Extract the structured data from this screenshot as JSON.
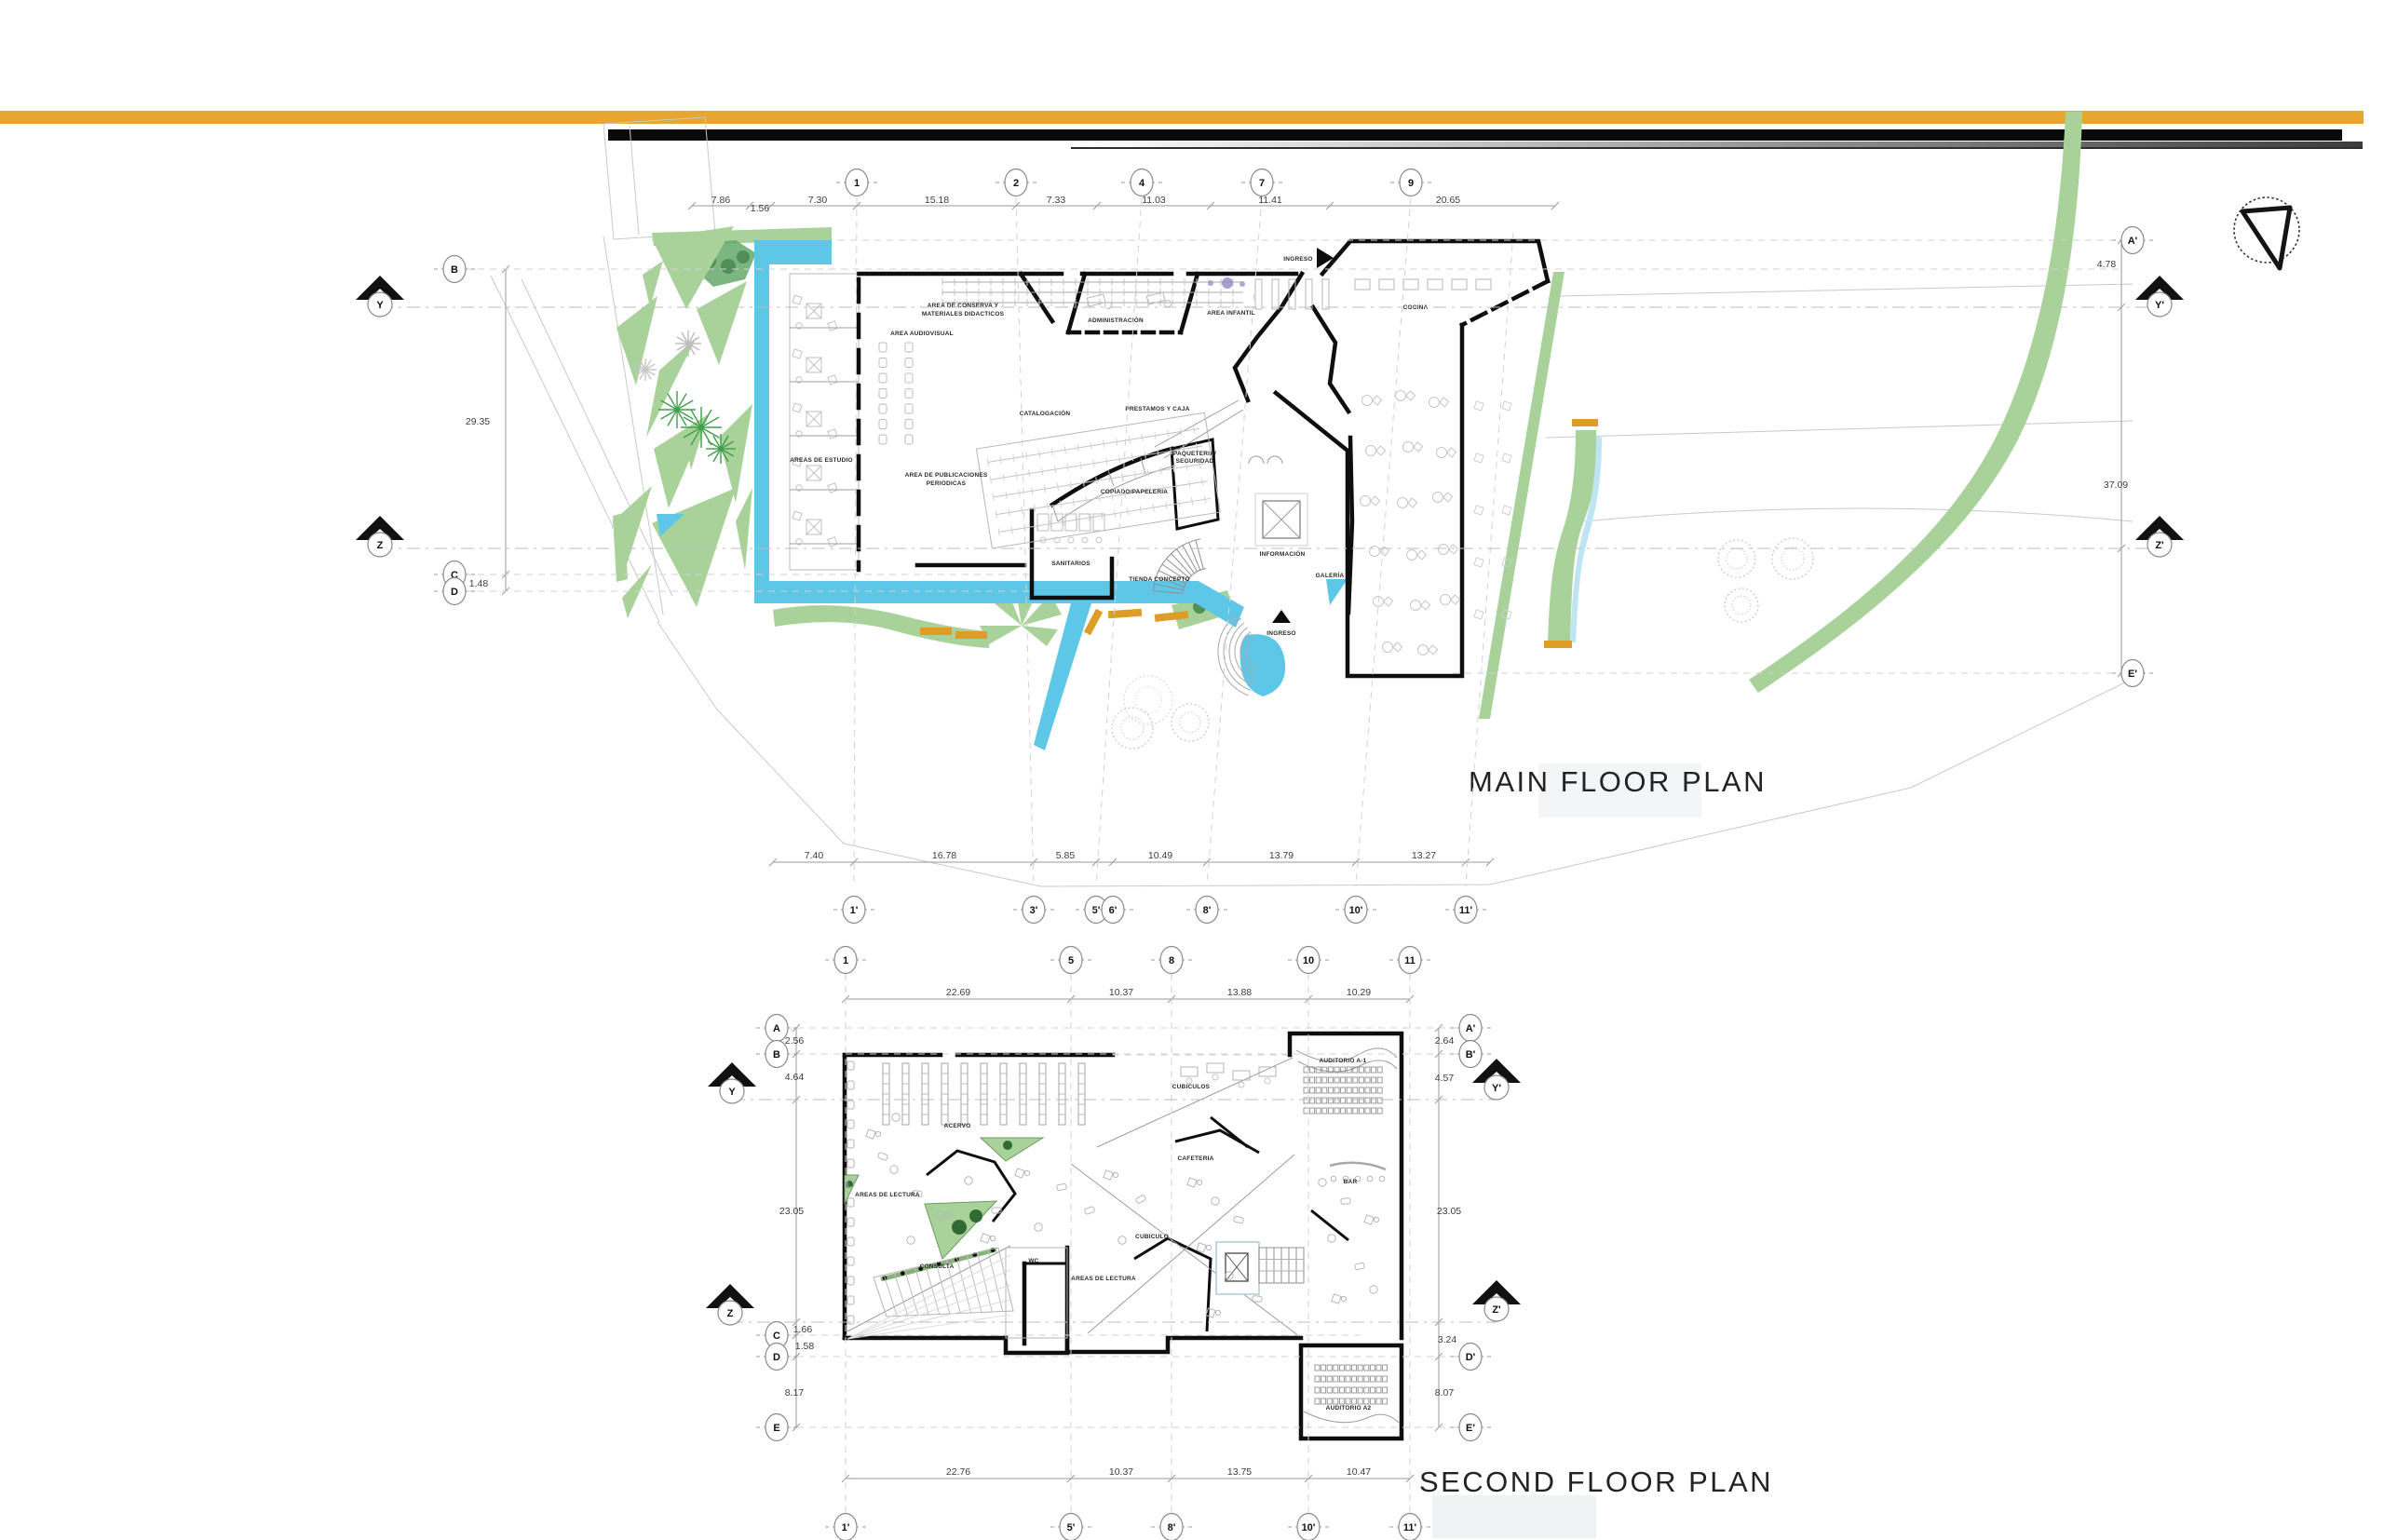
{
  "sheet": {
    "accent_bar_color": "#E7A62F",
    "black_bar_color": "#0A0A0A",
    "water_color": "#5EC7E8",
    "landscape_color": "#A9D29B",
    "bench_color": "#DD9D27"
  },
  "main": {
    "title": "MAIN FLOOR PLAN",
    "top_grid": [
      "1",
      "2",
      "4",
      "7",
      "9"
    ],
    "top_dims": [
      "7.86",
      "1.56",
      "7.30",
      "15.18",
      "7.33",
      "11.03",
      "11.41",
      "20.65"
    ],
    "bottom_grid": [
      "1'",
      "3'",
      "5'",
      "6'",
      "8'",
      "10'",
      "11'"
    ],
    "bottom_dims": [
      "7.40",
      "16.78",
      "5.85",
      "10.49",
      "13.79",
      "13.27"
    ],
    "left_rows": [
      "B",
      "C",
      "D"
    ],
    "left_dims": [
      "29.35",
      "1.48"
    ],
    "right_rows": [
      "A'",
      "E'"
    ],
    "right_dims": [
      "4.78",
      "37.09"
    ],
    "sections_left": [
      "Y",
      "Z"
    ],
    "sections_right": [
      "Y'",
      "Z'"
    ],
    "entrance_top": "INGRESO",
    "entrance_bottom": "INGRESO",
    "rooms": {
      "conserva1": "AREA DE CONSERVA Y",
      "conserva2": "MATERIALES DIDACTICOS",
      "audiovisual": "AREA AUDIOVISUAL",
      "estudio": "AREAS DE ESTUDIO",
      "publicaciones1": "AREA DE PUBLICACIONES",
      "publicaciones2": "PERIODICAS",
      "catalogacion": "CATALOGACIÓN",
      "prestamos": "PRESTAMOS Y CAJA",
      "administracion": "ADMINISTRACIÓN",
      "infantil": "AREA INFANTIL",
      "cocina": "COCINA",
      "sanitarios": "SANITARIOS",
      "copiado": "COPIADO/PAPELERIA",
      "paqueteria1": "PAQUETERIA/",
      "paqueteria2": "SEGURIDAD",
      "tienda": "TIENDA CONCEPTO",
      "informacion": "INFORMACIÓN",
      "galeria": "GALERÍA"
    }
  },
  "second": {
    "title": "SECOND FLOOR PLAN",
    "top_grid": [
      "1",
      "5",
      "8",
      "10",
      "11"
    ],
    "top_dims": [
      "22.69",
      "10.37",
      "13.88",
      "10.29"
    ],
    "bottom_grid": [
      "1'",
      "5'",
      "8'",
      "10'",
      "11'"
    ],
    "bottom_dims": [
      "22.76",
      "10.37",
      "13.75",
      "10.47"
    ],
    "left_rows": [
      "A",
      "B",
      "C",
      "D",
      "E"
    ],
    "left_dims": [
      "2.56",
      "4.64",
      "23.05",
      "1.66",
      "1.58",
      "8.17"
    ],
    "right_rows": [
      "A'",
      "B'",
      "D'",
      "E'"
    ],
    "right_dims": [
      "2.64",
      "4.57",
      "23.05",
      "3.24",
      "8.07"
    ],
    "sections_left": [
      "Y",
      "Z"
    ],
    "sections_right": [
      "Y'",
      "Z'"
    ],
    "rooms": {
      "acervo": "ACERVO",
      "lectura1": "AREAS DE LECTURA",
      "consulta": "CONSULTA",
      "wc": "WC",
      "cubiculo": "CUBICULO",
      "lectura2": "AREAS DE LECTURA",
      "cubiculos": "CUBICULOS",
      "cafeteria": "CAFETERIA",
      "bar": "BAR",
      "auditorio1": "AUDITORIO A-1",
      "auditorio2": "AUDITORIO A2"
    }
  }
}
